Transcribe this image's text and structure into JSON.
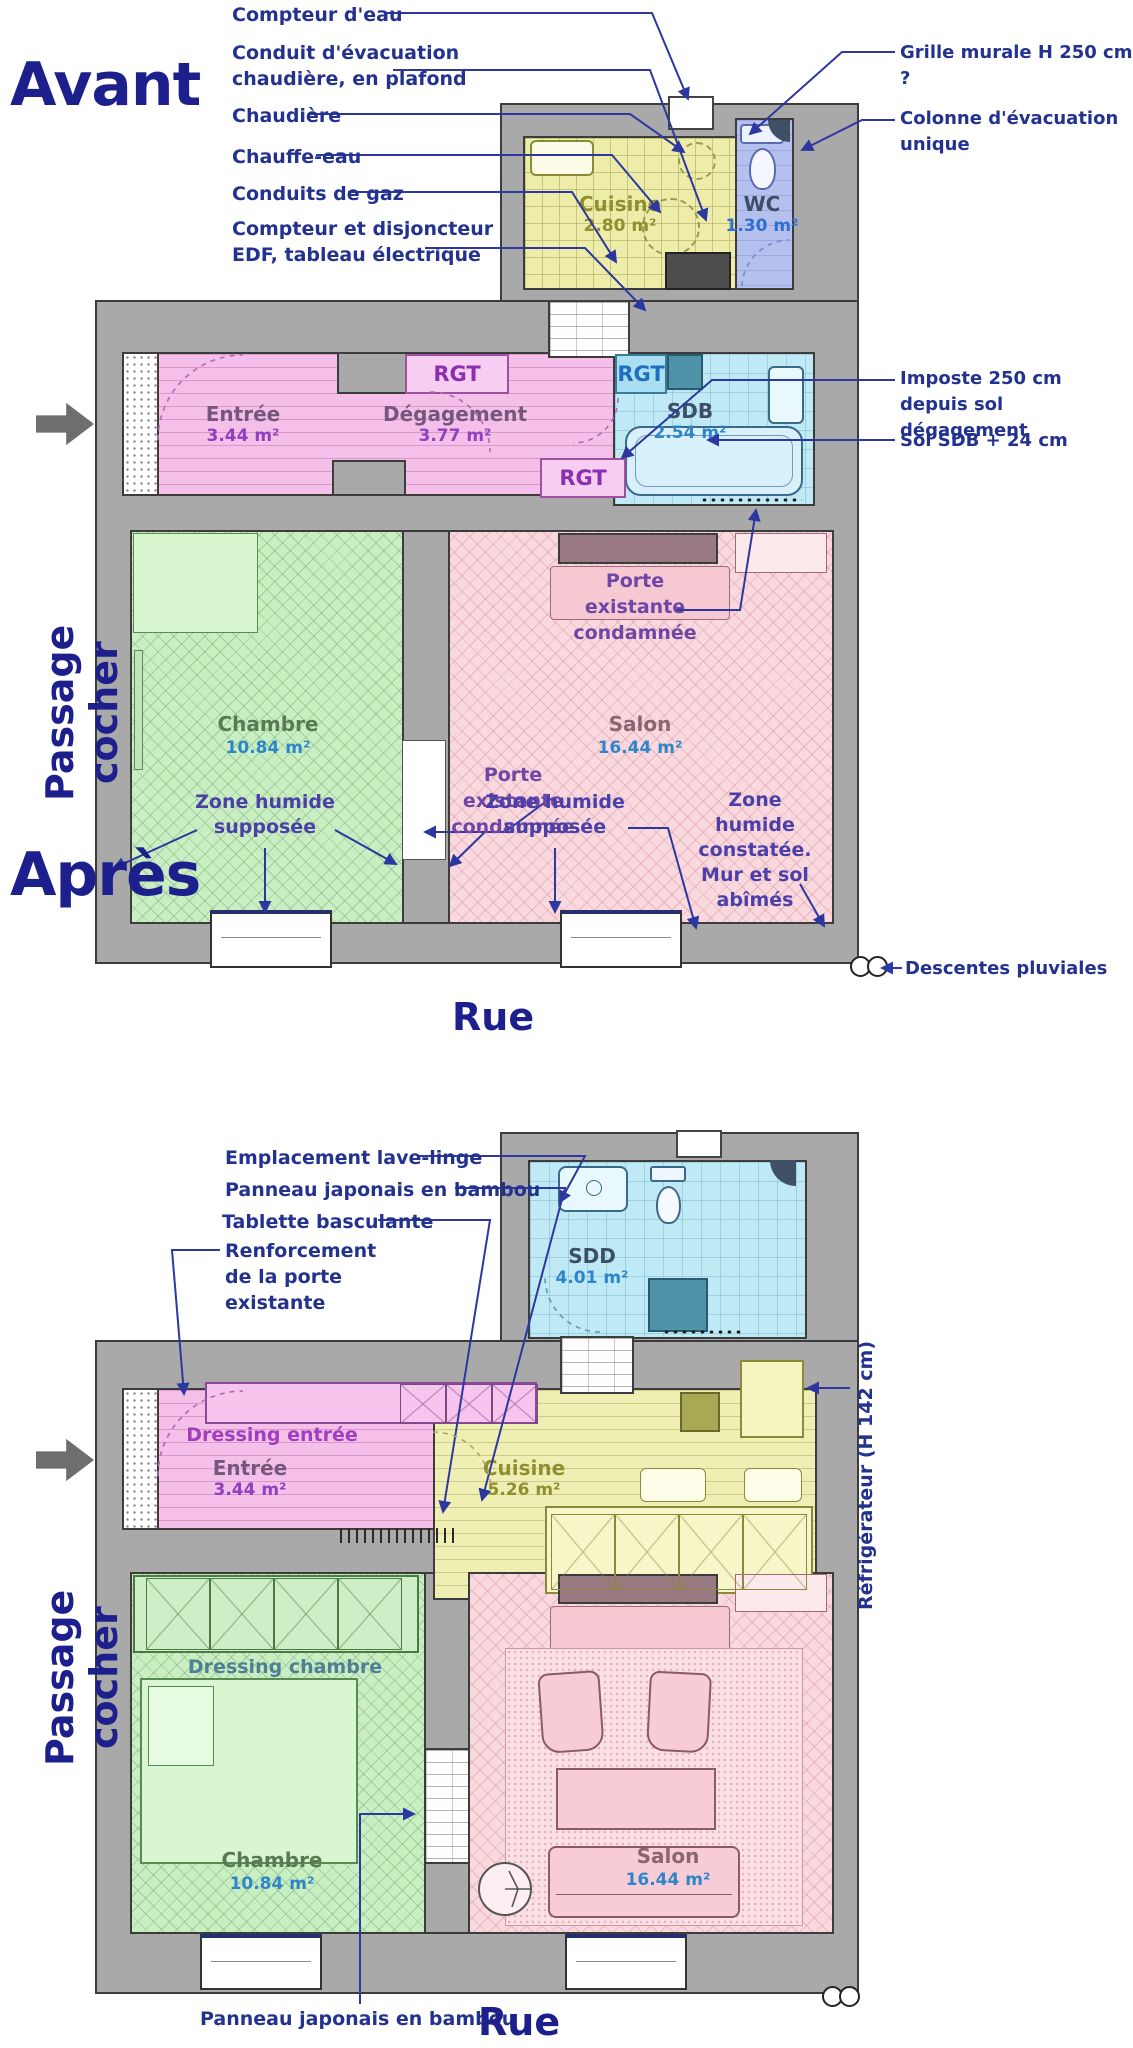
{
  "colors": {
    "annotation_navy": "#23318f",
    "title_navy": "#1c1f8c",
    "annotation_purple": "#6f46a8",
    "annotation_indigo": "#4b3fa8",
    "wall_gray": "#a9a9a9",
    "entry_pink": "#f4bfe8",
    "kitchen_yellow": "#ededa9",
    "bath_cyan": "#bfe9f4",
    "wc_blue": "#b6c0ef",
    "bedroom_green": "#c9eec2",
    "living_pink": "#f9d9de",
    "area_blue": "#2e86c8",
    "rgt_purple": "#8b2fb0"
  },
  "avant": {
    "title": "Avant",
    "street": "Rue",
    "passage": "Passage cocher",
    "callouts": {
      "compteur_eau": "Compteur d'eau",
      "conduit": "Conduit d'évacuation\nchaudière, en plafond",
      "chaudiere": "Chaudière",
      "chauffe_eau": "Chauffe-eau",
      "conduits_gaz": "Conduits de gaz",
      "compteur_edf": "Compteur et disjoncteur\nEDF, tableau électrique",
      "grille": "Grille murale H 250 cm ?",
      "colonne": "Colonne d'évacuation\nunique",
      "imposte": "Imposte 250 cm depuis sol\ndégagement",
      "sol_sdb": "Sol SDB + 24 cm",
      "descentes": "Descentes pluviales",
      "porte_condamnee_1": "Porte existante\ncondamnée",
      "porte_condamnee_2": "Porte existante\ncondamnée",
      "zone_supposee_1": "Zone humide\nsupposée",
      "zone_supposee_2": "Zone humide\nsupposée",
      "zone_constatee": "Zone humide\nconstatée.\nMur et sol\nabîmés"
    },
    "rgt1": "RGT",
    "rgt2": "RGT",
    "rgt3": "RGT",
    "rooms": {
      "cuisine": {
        "name": "Cuisine",
        "area": "2.80 m²"
      },
      "wc": {
        "name": "WC",
        "area": "1.30 m²"
      },
      "entree": {
        "name": "Entrée",
        "area": "3.44 m²"
      },
      "degagement": {
        "name": "Dégagement",
        "area": "3.77 m²"
      },
      "sdb": {
        "name": "SDB",
        "area": "2.54 m²"
      },
      "chambre": {
        "name": "Chambre",
        "area": "10.84 m²"
      },
      "salon": {
        "name": "Salon",
        "area": "16.44 m²"
      }
    }
  },
  "apres": {
    "title": "Après",
    "street": "Rue",
    "passage": "Passage cocher",
    "callouts": {
      "lave_linge": "Emplacement lave-linge",
      "panneau_haut": "Panneau japonais en bambou",
      "tablette": "Tablette basculante",
      "renforcement": "Renforcement\nde la porte\nexistante",
      "refrigerateur": "Réfrigérateur (H 142 cm)",
      "panneau_bas": "Panneau japonais en bambou"
    },
    "rooms": {
      "sdd": {
        "name": "SDD",
        "area": "4.01 m²"
      },
      "dressing_entree": {
        "name": "Dressing entrée"
      },
      "entree": {
        "name": "Entrée",
        "area": "3.44 m²"
      },
      "cuisine": {
        "name": "Cuisine",
        "area": "5.26 m²"
      },
      "dressing_chambre": {
        "name": "Dressing chambre"
      },
      "chambre": {
        "name": "Chambre",
        "area": "10.84 m²"
      },
      "salon": {
        "name": "Salon",
        "area": "16.44 m²"
      }
    }
  }
}
